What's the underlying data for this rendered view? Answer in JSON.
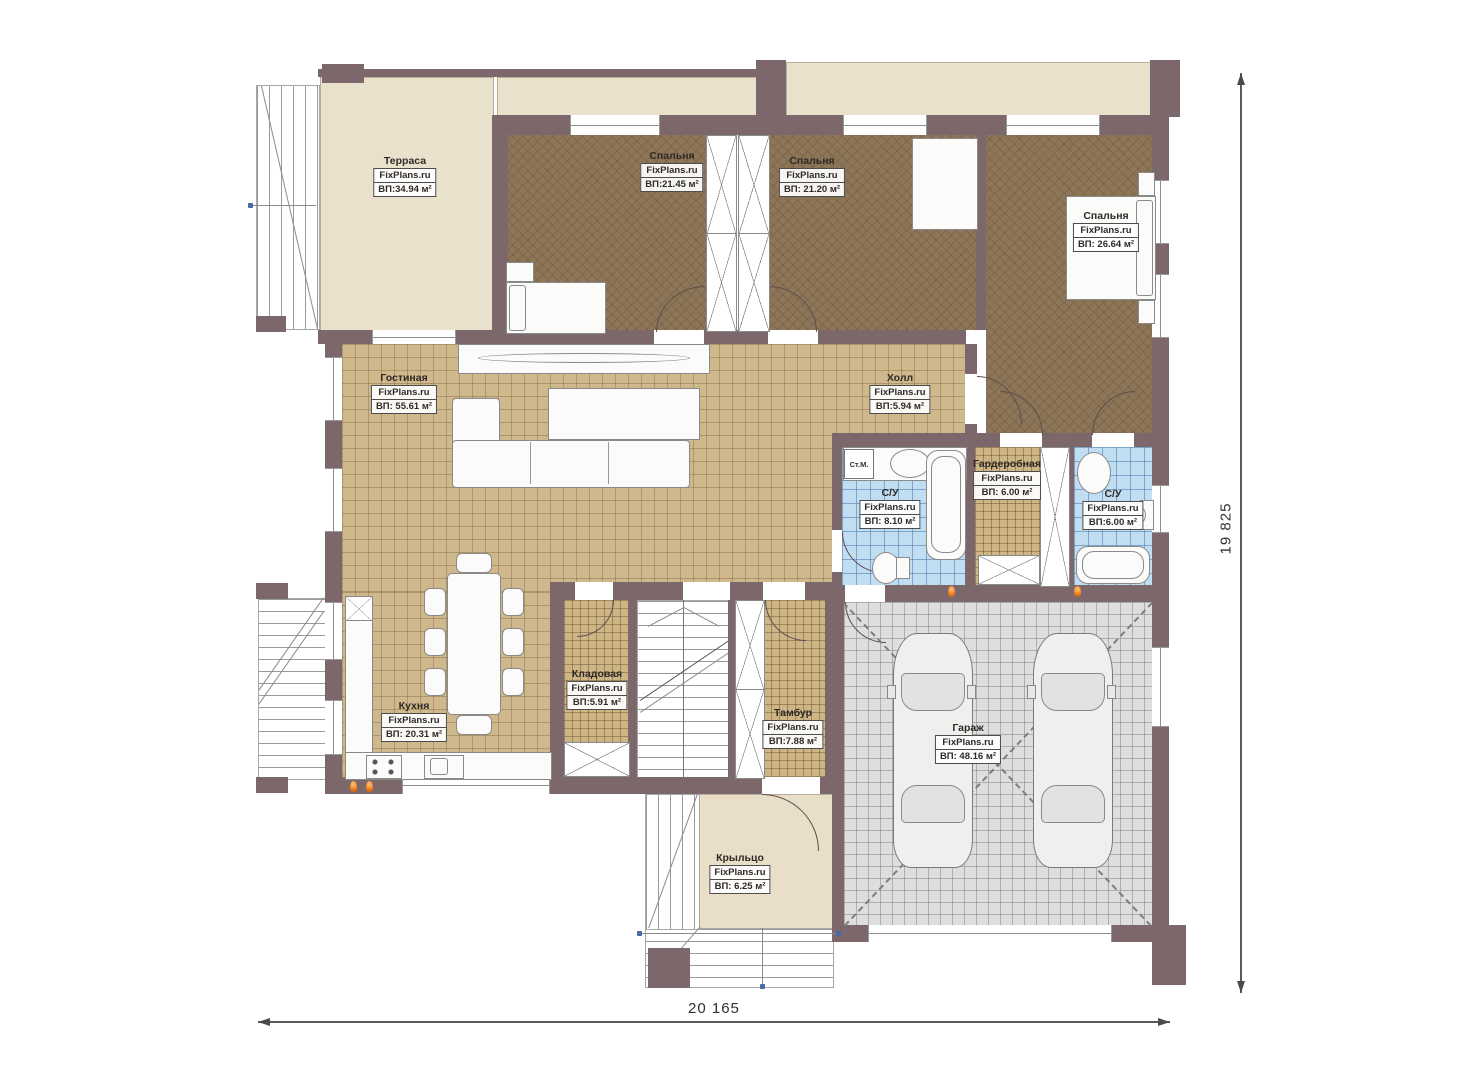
{
  "plan": {
    "title": "План 1-го этажа",
    "rooms": [
      {
        "name": "Терраса",
        "brand": "FixPlans.ru",
        "area": "ВП:34.94 м²"
      },
      {
        "name": "Спальня",
        "brand": "FixPlans.ru",
        "area": "ВП:21.45 м²"
      },
      {
        "name": "Спальня",
        "brand": "FixPlans.ru",
        "area": "ВП: 21.20 м²"
      },
      {
        "name": "Спальня",
        "brand": "FixPlans.ru",
        "area": "ВП: 26.64 м²"
      },
      {
        "name": "Гостиная",
        "brand": "FixPlans.ru",
        "area": "ВП: 55.61 м²"
      },
      {
        "name": "Холл",
        "brand": "FixPlans.ru",
        "area": "ВП:5.94 м²"
      },
      {
        "name": "С/У",
        "brand": "FixPlans.ru",
        "area": "ВП: 8.10 м²"
      },
      {
        "name": "Гардеробная",
        "brand": "FixPlans.ru",
        "area": "ВП: 6.00 м²"
      },
      {
        "name": "С/У",
        "brand": "FixPlans.ru",
        "area": "ВП:6.00 м²"
      },
      {
        "name": "Кухня",
        "brand": "FixPlans.ru",
        "area": "ВП: 20.31 м²"
      },
      {
        "name": "Кладовая",
        "brand": "FixPlans.ru",
        "area": "ВП:5.91 м²"
      },
      {
        "name": "Тамбур",
        "brand": "FixPlans.ru",
        "area": "ВП:7.88 м²"
      },
      {
        "name": "Гараж",
        "brand": "FixPlans.ru",
        "area": "ВП: 48.16 м²"
      },
      {
        "name": "Крыльцо",
        "brand": "FixPlans.ru",
        "area": "ВП: 6.25 м²"
      }
    ],
    "dimensions": {
      "width_mm": "20 165",
      "height_mm": "19 825"
    },
    "annotations": {
      "washing_machine": "Ст.М."
    },
    "colors": {
      "wall": "#7c676b",
      "terrace_floor": "#eae1cc",
      "bedroom_floor": "#8d7557",
      "living_floor": "#cfb88c",
      "bath_floor": "#c1ddf2",
      "garage_floor": "#dedede",
      "porch_floor": "#e9dfc9",
      "accent_flame": "#f07818"
    }
  }
}
